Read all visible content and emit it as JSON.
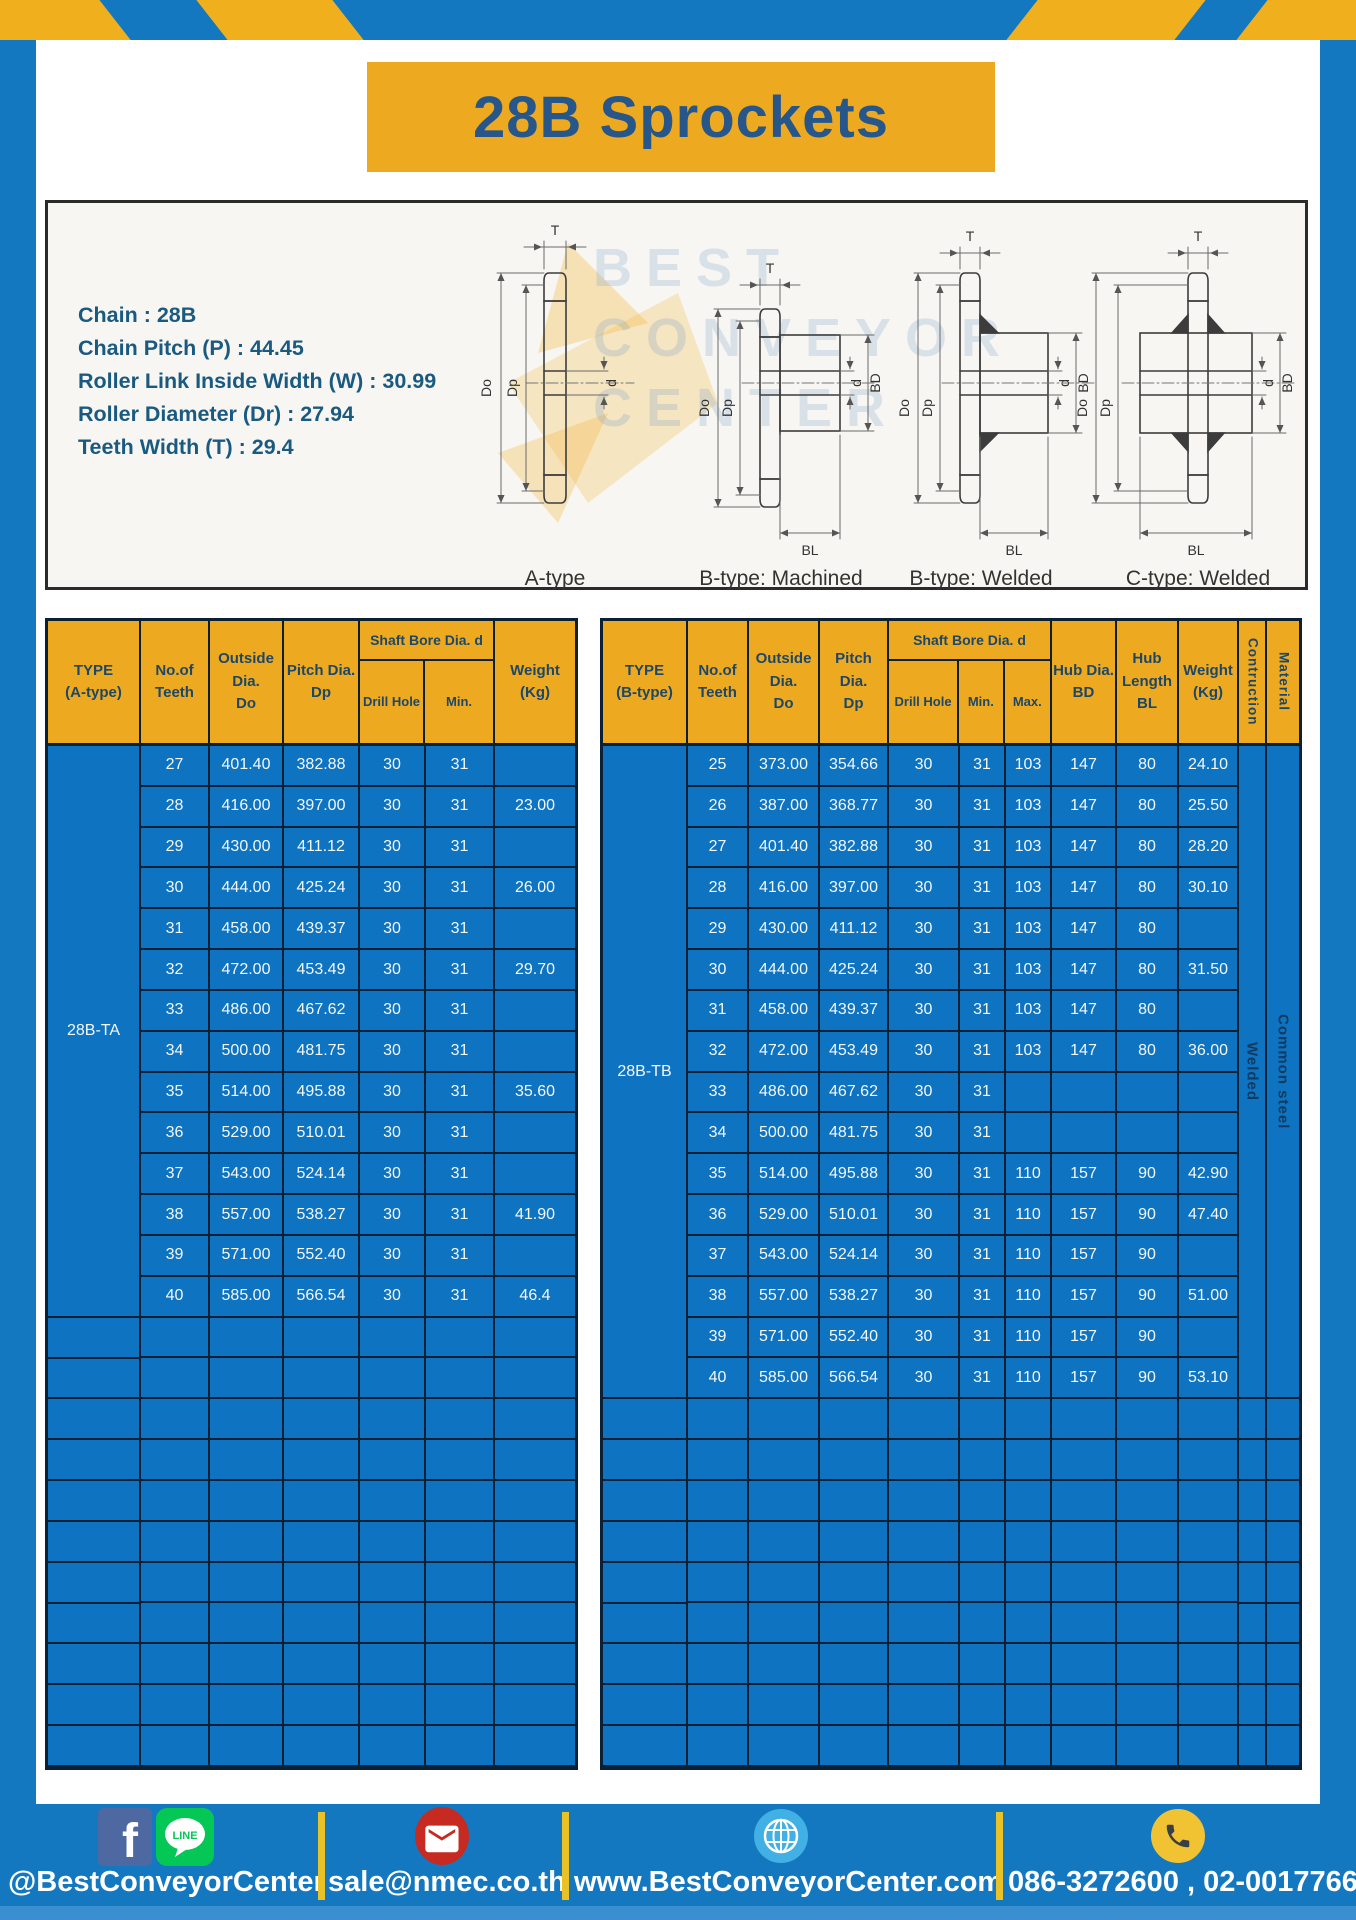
{
  "page": {
    "title": "28B Sprockets",
    "specs": [
      "Chain : 28B",
      "Chain Pitch (P) : 44.45",
      "Roller Link Inside Width (W) : 30.99",
      "Roller Diameter (Dr) : 27.94",
      "Teeth Width (T) : 29.4"
    ]
  },
  "diagram": {
    "labels": {
      "t": "T",
      "do": "Do",
      "dp": "Dp",
      "d": "d",
      "bd": "BD",
      "bl": "BL"
    },
    "captions": [
      "A-type",
      "B-type: Machined",
      "B-type: Welded",
      "C-type: Welded"
    ],
    "watermark": [
      "BEST",
      "CONVEYOR",
      "CENTER"
    ]
  },
  "left_table": {
    "header": {
      "type": "TYPE\n(A-type)",
      "teeth": "No.of\nTeeth",
      "outside": "Outside\nDia.\nDo",
      "pitch": "Pitch Dia.\nDp",
      "shaft_bore": "Shaft Bore Dia. d",
      "drill": "Drill Hole",
      "min": "Min.",
      "weight": "Weight\n(Kg)"
    },
    "type_label": "28B-TA",
    "columns": {
      "teeth": [
        "27",
        "28",
        "29",
        "30",
        "31",
        "32",
        "33",
        "34",
        "35",
        "36",
        "37",
        "38",
        "39",
        "40",
        "",
        "",
        "",
        "",
        "",
        "",
        "",
        "",
        "",
        "",
        ""
      ],
      "outside": [
        "401.40",
        "416.00",
        "430.00",
        "444.00",
        "458.00",
        "472.00",
        "486.00",
        "500.00",
        "514.00",
        "529.00",
        "543.00",
        "557.00",
        "571.00",
        "585.00",
        "",
        "",
        "",
        "",
        "",
        "",
        "",
        "",
        "",
        "",
        ""
      ],
      "pitch": [
        "382.88",
        "397.00",
        "411.12",
        "425.24",
        "439.37",
        "453.49",
        "467.62",
        "481.75",
        "495.88",
        "510.01",
        "524.14",
        "538.27",
        "552.40",
        "566.54",
        "",
        "",
        "",
        "",
        "",
        "",
        "",
        "",
        "",
        "",
        ""
      ],
      "drill": [
        "30",
        "30",
        "30",
        "30",
        "30",
        "30",
        "30",
        "30",
        "30",
        "30",
        "30",
        "30",
        "30",
        "30",
        "",
        "",
        "",
        "",
        "",
        "",
        "",
        "",
        "",
        "",
        ""
      ],
      "min": [
        "31",
        "31",
        "31",
        "31",
        "31",
        "31",
        "31",
        "31",
        "31",
        "31",
        "31",
        "31",
        "31",
        "31",
        "",
        "",
        "",
        "",
        "",
        "",
        "",
        "",
        "",
        "",
        ""
      ],
      "weight": [
        "",
        "23.00",
        "",
        "26.00",
        "",
        "29.70",
        "",
        "",
        "35.60",
        "",
        "",
        "41.90",
        "",
        "46.4",
        "",
        "",
        "",
        "",
        "",
        "",
        "",
        "",
        "",
        "",
        ""
      ]
    },
    "empty_rows": [
      "",
      "",
      "",
      "",
      "",
      "",
      "",
      "",
      "",
      "",
      ""
    ]
  },
  "right_table": {
    "header": {
      "type": "TYPE\n(B-type)",
      "teeth": "No.of\nTeeth",
      "outside": "Outside\nDia.\nDo",
      "pitch": "Pitch Dia.\nDp",
      "shaft_bore": "Shaft Bore Dia. d",
      "drill": "Drill Hole",
      "min": "Min.",
      "max": "Max.",
      "hub_dia": "Hub Dia.\nBD",
      "hub_len": "Hub\nLength\nBL",
      "weight": "Weight\n(Kg)",
      "construction": "Contruction",
      "material": "Material"
    },
    "type_label": "28B-TB",
    "construction_label": "Welded",
    "material_label": "Common steel",
    "columns": {
      "teeth": [
        "25",
        "26",
        "27",
        "28",
        "29",
        "30",
        "31",
        "32",
        "33",
        "34",
        "35",
        "36",
        "37",
        "38",
        "39",
        "40",
        "",
        "",
        "",
        "",
        "",
        "",
        "",
        "",
        ""
      ],
      "outside": [
        "373.00",
        "387.00",
        "401.40",
        "416.00",
        "430.00",
        "444.00",
        "458.00",
        "472.00",
        "486.00",
        "500.00",
        "514.00",
        "529.00",
        "543.00",
        "557.00",
        "571.00",
        "585.00",
        "",
        "",
        "",
        "",
        "",
        "",
        "",
        "",
        ""
      ],
      "pitch": [
        "354.66",
        "368.77",
        "382.88",
        "397.00",
        "411.12",
        "425.24",
        "439.37",
        "453.49",
        "467.62",
        "481.75",
        "495.88",
        "510.01",
        "524.14",
        "538.27",
        "552.40",
        "566.54",
        "",
        "",
        "",
        "",
        "",
        "",
        "",
        "",
        ""
      ],
      "drill": [
        "30",
        "30",
        "30",
        "30",
        "30",
        "30",
        "30",
        "30",
        "30",
        "30",
        "30",
        "30",
        "30",
        "30",
        "30",
        "30",
        "",
        "",
        "",
        "",
        "",
        "",
        "",
        "",
        ""
      ],
      "min": [
        "31",
        "31",
        "31",
        "31",
        "31",
        "31",
        "31",
        "31",
        "31",
        "31",
        "31",
        "31",
        "31",
        "31",
        "31",
        "31",
        "",
        "",
        "",
        "",
        "",
        "",
        "",
        "",
        ""
      ],
      "max": [
        "103",
        "103",
        "103",
        "103",
        "103",
        "103",
        "103",
        "103",
        "",
        "",
        "110",
        "110",
        "110",
        "110",
        "110",
        "110",
        "",
        "",
        "",
        "",
        "",
        "",
        "",
        "",
        ""
      ],
      "hub_dia": [
        "147",
        "147",
        "147",
        "147",
        "147",
        "147",
        "147",
        "147",
        "",
        "",
        "157",
        "157",
        "157",
        "157",
        "157",
        "157",
        "",
        "",
        "",
        "",
        "",
        "",
        "",
        "",
        ""
      ],
      "hub_len": [
        "80",
        "80",
        "80",
        "80",
        "80",
        "80",
        "80",
        "80",
        "",
        "",
        "90",
        "90",
        "90",
        "90",
        "90",
        "90",
        "",
        "",
        "",
        "",
        "",
        "",
        "",
        "",
        ""
      ],
      "weight": [
        "24.10",
        "25.50",
        "28.20",
        "30.10",
        "",
        "31.50",
        "",
        "36.00",
        "",
        "",
        "42.90",
        "47.40",
        "",
        "51.00",
        "",
        "53.10",
        "",
        "",
        "",
        "",
        "",
        "",
        "",
        "",
        ""
      ]
    },
    "empty_rows": [
      "",
      "",
      "",
      "",
      "",
      "",
      "",
      "",
      ""
    ]
  },
  "footer": {
    "social_handle": "@BestConveyorCenter",
    "line_label": "LINE",
    "email": "sale@nmec.co.th",
    "website": "www.BestConveyorCenter.com",
    "phone": "086-3272600 , 02-0017766"
  },
  "colors": {
    "frame_blue": "#1478c0",
    "stripe_yellow": "#f0b01e",
    "banner_yellow": "#edaa20",
    "table_blue": "#0e73c0",
    "navy_text": "#1d4768",
    "divider_yellow": "#e9c227",
    "facebook_blue": "#4e69a2",
    "line_green": "#05c756",
    "mail_red": "#c62a20",
    "globe_blue": "#41b0e4",
    "phone_yellow": "#f1c232"
  }
}
